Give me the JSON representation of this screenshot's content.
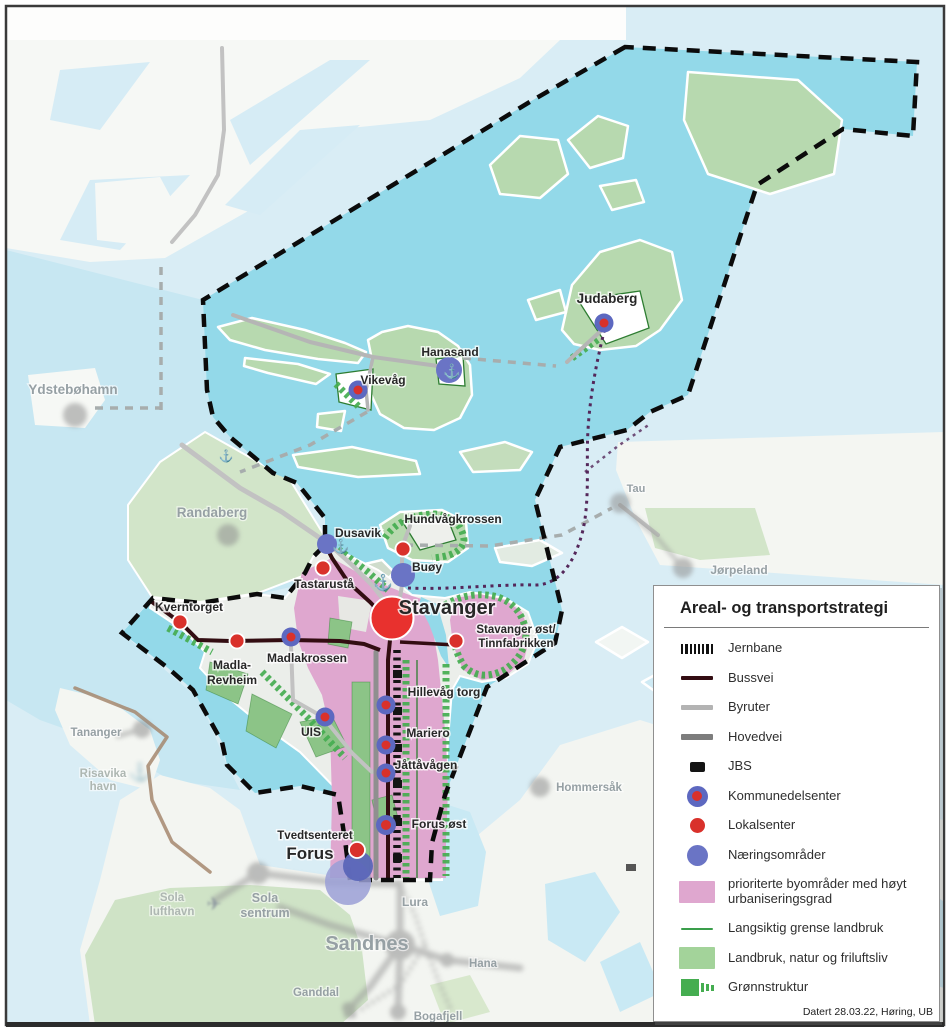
{
  "legend": {
    "title": "Areal- og transportstrategi",
    "footer": "Datert 28.03.22, Høring, UB",
    "items": [
      {
        "label": "Jernbane",
        "symbol": "railway"
      },
      {
        "label": "Bussvei",
        "symbol": "bus-rapid-line",
        "color": "#330d12"
      },
      {
        "label": "Byruter",
        "symbol": "city-route-line",
        "color": "#b3b3b3"
      },
      {
        "label": "Hovedvei",
        "symbol": "main-road-line",
        "color": "#7d7d7d"
      },
      {
        "label": "JBS",
        "symbol": "train-station-square",
        "color": "#141414"
      },
      {
        "label": "Kommunedelsenter",
        "symbol": "district-center-dot",
        "color": "#5d68c0"
      },
      {
        "label": "Lokalsenter",
        "symbol": "local-center-dot",
        "color": "#d9312b"
      },
      {
        "label": "Næringsområder",
        "symbol": "business-area-dot",
        "color": "#6a74c5"
      },
      {
        "label": "prioriterte byområder med høyt urbaniseringsgrad",
        "symbol": "urban-area-swatch",
        "color": "#dfa7cf"
      },
      {
        "label": "Langsiktig grense landbruk",
        "symbol": "agri-boundary-line",
        "color": "#3a9e4b"
      },
      {
        "label": "Landbruk, natur og friluftsliv",
        "symbol": "agriculture-swatch",
        "color": "#a3d39a"
      },
      {
        "label": "Grønnstruktur",
        "symbol": "green-structure",
        "color": "#45ad50"
      }
    ]
  },
  "map": {
    "places": {
      "stavanger": "Stavanger",
      "forus": "Forus",
      "sandnes": "Sandnes",
      "judaberg": "Judaberg",
      "hanasand": "Hanasand",
      "vikevag": "Vikevåg",
      "dusavik": "Dusavik",
      "hundvagkrossen": "Hundvågkrossen",
      "tastarusta": "Tastarustå",
      "buoy": "Buøy",
      "kverntorget": "Kverntorget",
      "stavanger_ost_1": "Stavanger øst/",
      "stavanger_ost_2": "Tinnfabrikken",
      "madla_1": "Madla-",
      "madla_2": "Revheim",
      "madlakrossen": "Madlakrossen",
      "hillevag_torg": "Hillevåg torg",
      "uis": "UIS",
      "mariero": "Mariero",
      "jattavagen": "Jåttåvågen",
      "forus_ost": "Forus øst",
      "tvedtsenteret": "Tvedtsenteret",
      "ydstebohamn": "Ydstebøhamn",
      "randaberg": "Randaberg",
      "tau": "Tau",
      "jorpeland": "Jørpeland",
      "tananger": "Tananger",
      "risavika_1": "Risavika",
      "risavika_2": "havn",
      "hommersak": "Hommersåk",
      "sola_lufthavn_1": "Sola",
      "sola_lufthavn_2": "lufthavn",
      "sola_sentrum_1": "Sola",
      "sola_sentrum_2": "sentrum",
      "lura": "Lura",
      "hana": "Hana",
      "ganddal": "Ganddal",
      "bogafjell": "Bogafjell"
    },
    "icons": {
      "anchor": "⚓",
      "plane": "✈"
    },
    "colors": {
      "strategy_water": "#93d9e9",
      "outside_water": "#d9edf5",
      "land_white": "#f6f8f5",
      "land_green_inside": "#b7d9af",
      "land_green_outside": "#d2e5c9",
      "urban_pink": "#dfa7cf",
      "green_structure": "#45ad50",
      "bussvei": "#330d12",
      "byruter": "#c2c2c2",
      "hovedvei": "#8f8f8f",
      "railway": "#141414",
      "district_center": "#5d68c0",
      "local_center": "#d9312b",
      "business_area": "#6a74c5",
      "boundary": "#0b0b0b"
    }
  }
}
